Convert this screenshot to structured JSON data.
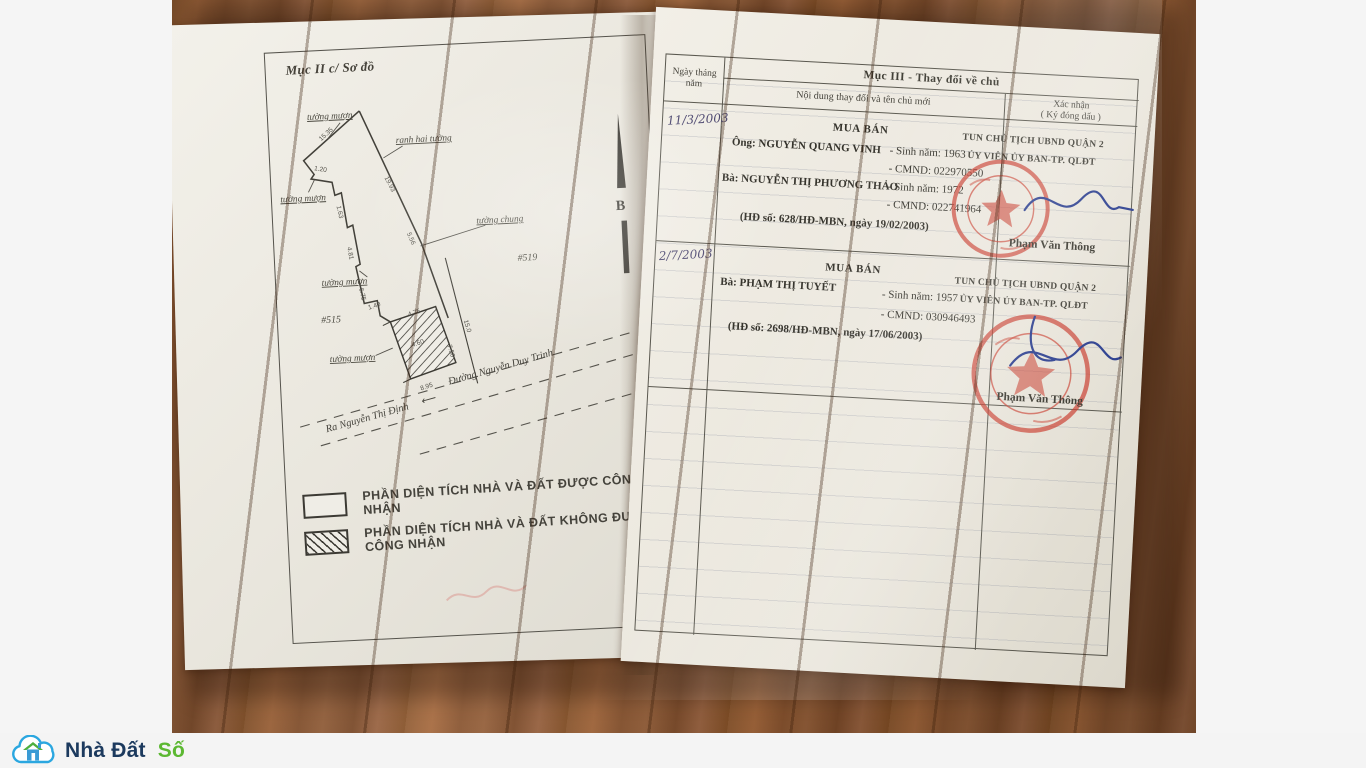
{
  "left_page": {
    "section_title": "Mục II c/ Sơ đồ",
    "diagram": {
      "wall_borrowed_1": "tường mượn",
      "wall_borrowed_2": "tường mượn",
      "wall_borrowed_3": "tường mượn",
      "wall_borrowed_4": "tường mượn",
      "boundary_label": "ranh hai tường",
      "wall_shared": "tường chung",
      "parcel_left": "#515",
      "parcel_right": "#519",
      "north_letter": "B",
      "road_direction": "Ra Nguyễn Thị Định",
      "road_arrow": "⟵",
      "road_name": "Đường Nguyễn Duy Trinh",
      "dims": {
        "d0": "15.35",
        "d1": "19.93",
        "d2": "1.20",
        "d3": "1.63",
        "d4": "4.81",
        "d5": "6.75",
        "d6": "5.56",
        "d7": "1.40",
        "d8": "4.75",
        "d9": "15.0",
        "d10": "7.50",
        "d11": "4.60",
        "d12": "8.95"
      }
    },
    "legend": {
      "item1": "PHẦN DIỆN TÍCH NHÀ VÀ ĐẤT ĐƯỢC CÔNG NHẬN",
      "item2": "PHẦN DIỆN TÍCH NHÀ VÀ ĐẤT KHÔNG ĐƯỢC CÔNG NHẬN"
    }
  },
  "right_page": {
    "title": "Mục III - Thay đổi về chủ",
    "col_date_1": "Ngày tháng",
    "col_date_2": "năm",
    "col_content": "Nội dung thay đổi và tên chủ mới",
    "col_confirm_1": "Xác nhận",
    "col_confirm_2": "( Ký đóng dấu )",
    "entries": [
      {
        "date": "11/3/2003",
        "type_label": "MUA BÁN",
        "party1": "Ông: NGUYỄN QUANG VINH",
        "party1_birth": "- Sinh năm: 1963",
        "party1_id": "- CMND: 022970550",
        "party2": "Bà: NGUYỄN THỊ PHƯƠNG THẢO",
        "party2_birth": "- Sinh năm: 1972",
        "party2_id": "- CMND: 022741964",
        "contract": "(HĐ số:  628/HĐ-MBN, ngày 19/02/2003)",
        "confirm_line1": "TUN CHỦ TỊCH UBND QUẬN 2",
        "confirm_line2": "ỦY VIÊN ỦY BAN-TP. QLĐT",
        "signer": "Phạm Văn Thông"
      },
      {
        "date": "2/7/2003",
        "type_label": "MUA BÁN",
        "party1": "Bà: PHẠM THỊ TUYẾT",
        "party1_birth": "- Sinh năm: 1957",
        "party1_id": "- CMND: 030946493",
        "contract": "(HĐ số:  2698/HĐ-MBN, ngày 17/06/2003)",
        "confirm_line1": "TUN CHỦ TỊCH UBND QUẬN 2",
        "confirm_line2": "ỦY VIÊN ỦY BAN-TP. QLĐT",
        "signer": "Phạm Văn Thông"
      }
    ]
  },
  "watermark": {
    "brand_part1": "Nhà Đất",
    "brand_part2": "Số"
  },
  "colors": {
    "seal_red": "#c83a2b",
    "signature_blue": "#2c3f8f",
    "brand_blue": "#2ba7e0",
    "brand_navy": "#1c3a5e",
    "brand_green": "#5cb832",
    "wood_brown": "#8f5a31"
  }
}
